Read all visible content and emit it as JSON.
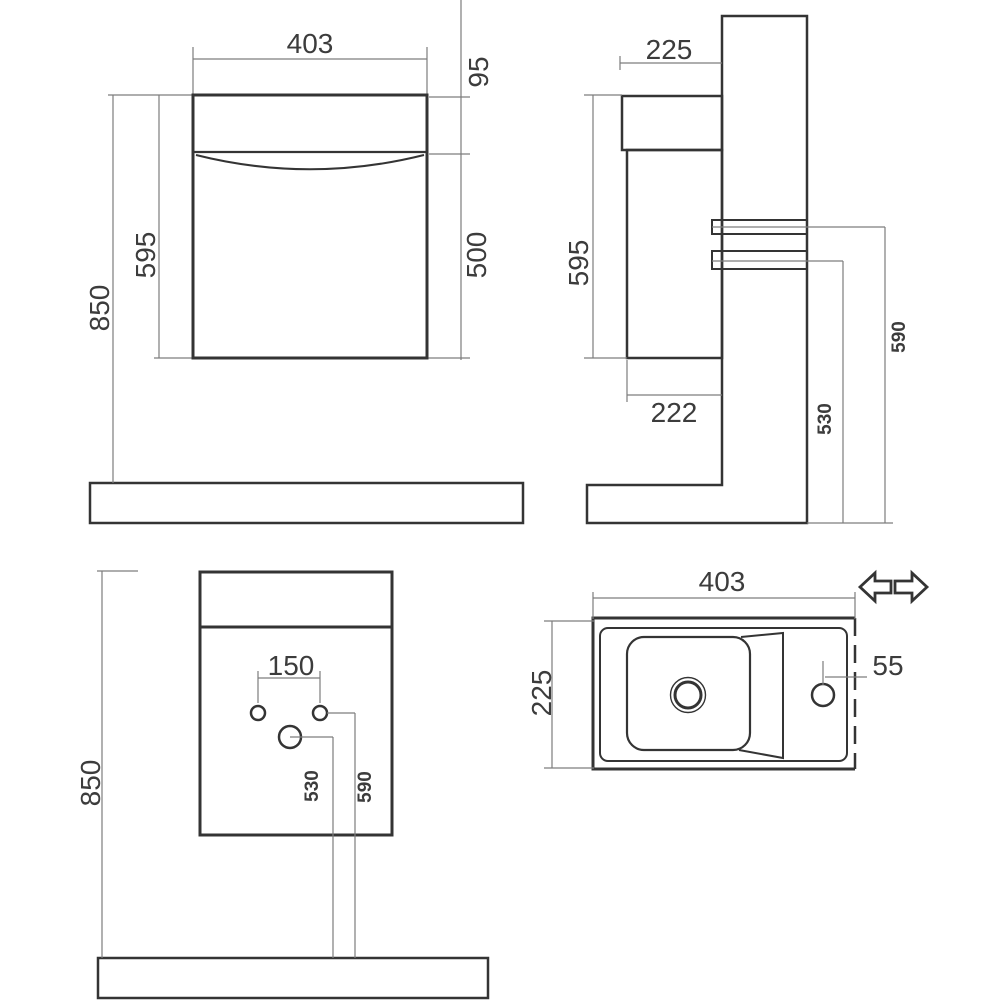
{
  "drawing": {
    "type": "technical-dimension-drawing",
    "subject": "wall-hung vanity unit with washbasin, four orthographic views",
    "units": "mm",
    "front_view": {
      "width": "403",
      "drawer_front_height": "95",
      "door_height": "500",
      "cabinet_height": "595",
      "top_height_from_floor": "850"
    },
    "side_view": {
      "depth": "225",
      "cabinet_height": "595",
      "body_depth": "222",
      "lower_fixing_height": "530",
      "upper_fixing_height": "590"
    },
    "mounting_view": {
      "top_height_from_floor": "850",
      "fixing_hole_spacing": "150",
      "drain_height": "530",
      "fixing_hole_height": "590"
    },
    "plan_view": {
      "width": "403",
      "depth": "225",
      "tap_hole_offset": "55"
    },
    "icons": {
      "reversible_arrows": "left-right reversible tap hole indicator"
    },
    "colors": {
      "line": "#343434",
      "dimension_line": "#7d7d7d",
      "text": "#3c3c3c",
      "background": "#ffffff"
    }
  }
}
